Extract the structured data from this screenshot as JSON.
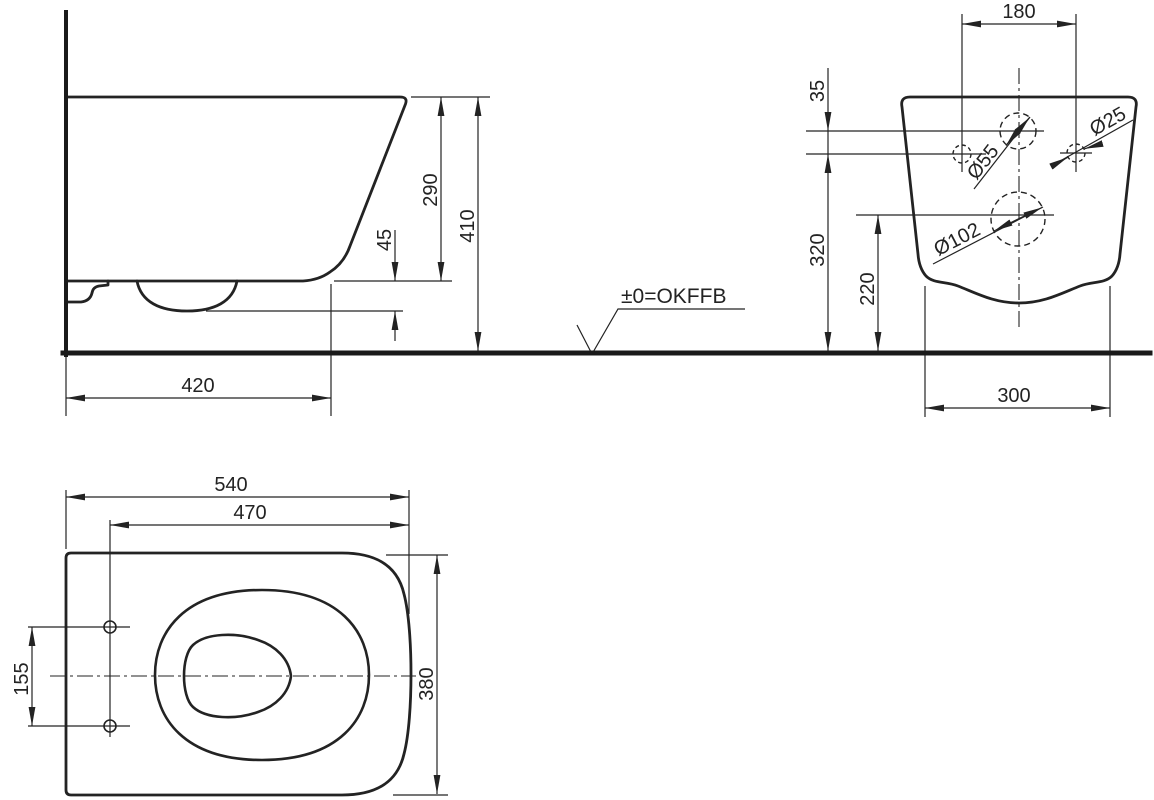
{
  "colors": {
    "line": "#232323",
    "heavy_line": "#1a1a1a",
    "background": "#ffffff"
  },
  "datum": {
    "label": "±0=OKFFB"
  },
  "side_view": {
    "total_height": "410",
    "rim_to_bottom": "290",
    "bottom_to_trap": "45",
    "floor_depth": "420"
  },
  "rear_view": {
    "fixing_hole_spacing": "180",
    "supply_above_fixing": "35",
    "fixing_height": "320",
    "outlet_height": "220",
    "base_width": "300",
    "supply_hole_dia": "Ø55",
    "fixing_hole_dia": "Ø25",
    "outlet_dia": "Ø102"
  },
  "top_view": {
    "overall_length": "540",
    "front_to_fixing": "470",
    "fixing_hole_spacing": "155",
    "overall_width": "380"
  }
}
